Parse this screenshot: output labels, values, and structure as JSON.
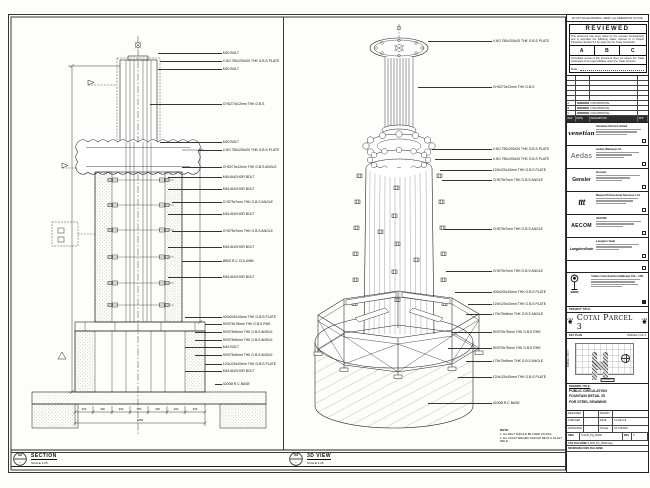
{
  "section_view": {
    "bubble_no": "02",
    "bubble_ref": "-",
    "title": "SECTION",
    "scale": "SCALE 1:25",
    "callouts": [
      "M20 BOLT",
      "4 NO 750x200x20 THK G.B.S PLATE",
      "M20 BOLT",
      "CHS273x12mm THK G.B.S",
      "M20 BOLT",
      "4 NO 750x200x20 THK G.B.S PLATE",
      "CHS273x12mm THK G.B.S ANGLE",
      "M16 ANCHOR BOLT",
      "M16 ANCHOR BOLT",
      "CHS75x7mm THK G.B.S ANGLE",
      "M16 ANCHOR BOLT",
      "CHS75x7mm THK G.B.S ANGLE",
      "M16 ANCHOR BOLT",
      "Ø500 R.C COLUMN",
      "M16 ANCHOR BOLT",
      "400x200x10mm THK G.B.S PLATE",
      "SHS75x75mm THK G.B.S RHS",
      "SHS75x5mm THK G.B.S ANGLE",
      "SHS75x5mm THK G.B.S ANGLE",
      "M16 BOLT",
      "SHS75x5mm THK G.B.S ANGLE",
      "120x120x10mm THK G.B.S PLATE",
      "M16 ANCHOR BOLT",
      "4200Ø R.C BASE"
    ],
    "dims": [
      "300",
      "400",
      "300",
      "450",
      "300",
      "400",
      "300"
    ],
    "dim_total": "2450"
  },
  "view_3d": {
    "bubble_no": "03",
    "bubble_ref": "-",
    "title": "3D VIEW",
    "scale": "SCALE 1:25",
    "callouts": [
      "4 NO 750x200x20 THK G.B.S PLATE",
      "CHS273x12mm THK G.B.S",
      "4 NO 750x200x20 THK G.B.S PLATE",
      "4 NO 750x200x20 THK G.B.S PLATE",
      "120x120x10mm THK G.B.S PLATE",
      "CHS75x7mm THK G.B.S ANGLE",
      "CHS75x7mm THK G.B.S ANGLE",
      "CHS75x7mm THK G.B.S ANGLE",
      "400x200x10mm THK G.B.S PLATE",
      "120x120x10mm THK G.B.S PLATE",
      "L75x75x6mm THK G.B.S ANGLE",
      "SHS75x75mm THK G.B.S RHS",
      "SHS75x75mm THK G.B.S RHS",
      "L75x75x6mm THK G.B.S ANGLE",
      "120x120x10mm THK G.B.S PLATE",
      "4200Ø R.C BASE"
    ]
  },
  "notes": {
    "heading": "NOTE:",
    "line1": "1. ALL BOLT SHOULD BE FIXED ON SITE.",
    "line2": "2. ALL FILLET WELDED SHOULD BE 6mm FILLET WELD."
  },
  "titleblock": {
    "top_note": "DO NOT SCALE DRAWING. VERIFY ALL DIMENSIONS ON SITE.",
    "stamp": {
      "title": "REVIEWED",
      "body": "This document has been noted by the relevant Consultant(s) and is accorded the following status referred  to in Project Procedure Section 5.4 for action by the Trade Contractor.",
      "a": "A",
      "b": "B",
      "c": "C",
      "footer": "Consultant review of this document does not relieve the Trade Contractor of its responsibilities under the Trade Contract.",
      "date_label": "Date :"
    },
    "rev_header": {
      "rev": "REV",
      "date": "DATE",
      "desc": "DESCRIPTION",
      "app": "APP"
    },
    "revisions": [
      {
        "rev": "A",
        "desc": "FOR APPROVAL"
      },
      {
        "rev": "B",
        "desc": "FOR APPROVAL"
      },
      {
        "rev": "C",
        "desc": "FOR APPROVAL"
      }
    ],
    "companies": [
      {
        "logo": "venetian",
        "name": "Venetian Orient Limited"
      },
      {
        "logo": "Aedas",
        "name": "Aedas (Macau) Ltd."
      },
      {
        "logo": "Gensler",
        "name": "Gensler"
      },
      {
        "logo": "ttt",
        "name": "Macau Professional Services Ltd."
      },
      {
        "logo": "AECOM",
        "name": "AECOM"
      },
      {
        "logo": "LangdonSeah",
        "name": "Langdon Seah"
      }
    ],
    "contractor": {
      "name": "Yudao Construction (Macau) CO., LTD."
    },
    "project_title_label": "PROJECT TITLE:",
    "project_title": "Cotai Parcel 3",
    "key_plan": {
      "label": "KEY PLAN",
      "right": "PARCEL 3 OF 3",
      "side": "PARCEL 1 OF 3",
      "tag": "PARCEL 3"
    },
    "drawing_title_label": "DRAWING TITLE:",
    "drawing_title": {
      "l1": "PUBLIC CIRCULATION",
      "l2": "FOUNTAIN DETAIL 25",
      "l3": "FOR STEEL DRAWING"
    },
    "meta": {
      "designed_label": "DESIGNED",
      "designed_val": "-",
      "drawn_label": "DRAWN",
      "drawn_val": "-",
      "checked_label": "CHECKED",
      "checked_val": "-",
      "approved_label": "APPROVED",
      "approved_val": "-",
      "date_label": "DATE",
      "date_val": "14-JUN-19",
      "scale_label": "SCALE",
      "scale_val": "AS SHOWN",
      "dwg_label": "DWG NO",
      "dwg_val": "S-SUB_PQ_00000",
      "rev_label": "REV",
      "rev_val": "C",
      "cad_label": "CAD FILE NAME",
      "cad_val": "S-SUB_PQ_00000.dwg",
      "ref_label": "REFERENCE DWG FILE NAME"
    }
  }
}
